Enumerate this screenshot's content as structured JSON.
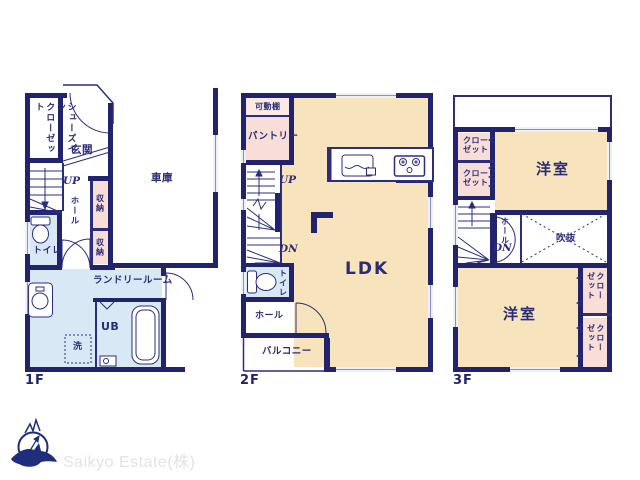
{
  "brand": {
    "name": "Saikyo Estate(株)"
  },
  "colors": {
    "wall_navy": "#21236d",
    "text_navy": "#2a2c77",
    "room_cream": "#f7e4bd",
    "closet_pink": "#f9ded7",
    "wet_area_blue": "#d9e8f5",
    "brand_gray": "#e3e3e3"
  },
  "floor1": {
    "label": "1F",
    "rooms": {
      "shoes_closet": "シューズイン\nクローゼット",
      "entrance": "玄関",
      "garage": "車庫",
      "up": "UP",
      "hall": "ホール",
      "storage_a": "収納",
      "storage_b": "収納",
      "toilet": "トイレ",
      "laundry": "ランドリールーム",
      "bath": "UB",
      "washer": "洗"
    }
  },
  "floor2": {
    "label": "2F",
    "rooms": {
      "shelf": "可動棚",
      "pantry": "パントリー",
      "up": "UP",
      "down": "DN",
      "toilet": "トイレ",
      "hall": "ホール",
      "balcony": "バルコニー",
      "ldk": "LDK"
    }
  },
  "floor3": {
    "label": "3F",
    "rooms": {
      "closet_a": "クロー\nゼット",
      "closet_b": "クロー\nゼット",
      "room_upper": "洋室",
      "hall": "ホール",
      "down": "DN",
      "void": "吹抜",
      "room_lower": "洋室",
      "closet_c": "クロー\nゼット",
      "closet_d": "クロー\nゼット"
    }
  }
}
